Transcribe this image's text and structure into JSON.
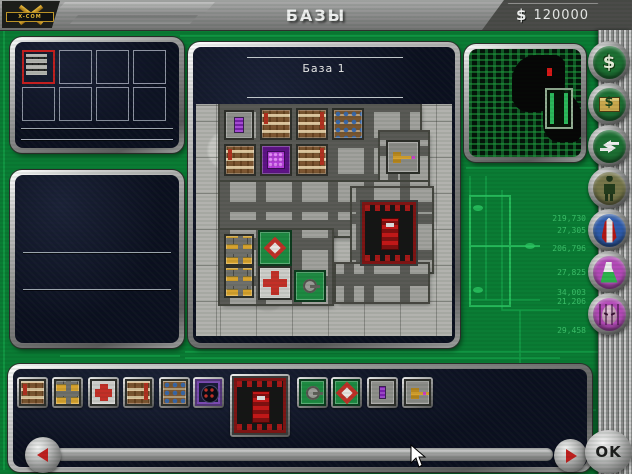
{
  "topbar": {
    "logo_text": "X-COM",
    "title": "БАЗЫ",
    "currency_glyph": "$",
    "money": "120000"
  },
  "base_list": {
    "slot_count": 8,
    "selected_index": 0
  },
  "base_view": {
    "title": "База 1",
    "facilities": [
      "access-lift",
      "living-quarters",
      "living-quarters",
      "laboratory",
      "living-quarters",
      "psi-lab",
      "living-quarters",
      "workshop",
      "general-stores",
      "missile-defense",
      "general-stores",
      "medical-bay",
      "gun-defense",
      "hangar"
    ]
  },
  "minimap": {
    "marker_color": "#d81818"
  },
  "toolbar": {
    "buttons": [
      {
        "id": "funds",
        "glyph": "$"
      },
      {
        "id": "sell",
        "glyph": "$"
      },
      {
        "id": "transfer"
      },
      {
        "id": "soldiers"
      },
      {
        "id": "craft"
      },
      {
        "id": "research"
      },
      {
        "id": "alien-containment"
      }
    ]
  },
  "facility_strip": {
    "items": [
      "living-quarters",
      "general-stores",
      "medical-bay",
      "living-quarters",
      "laboratory",
      "alien-containment",
      "hangar",
      "gun-defense",
      "missile-defense",
      "access-lift",
      "workshop"
    ]
  },
  "ok": {
    "label": "OK"
  },
  "pcb": {
    "numbers": [
      "219,730",
      "27,305",
      "206,796",
      "27,825",
      "34,003",
      "21,206",
      "29,458",
      "4,299"
    ]
  },
  "colors": {
    "background": "#0a7c34",
    "trace": "#17a94e",
    "panel": "#0b0f1f",
    "selected_slot": "#c21f1f",
    "money_text": "#e9e9e9"
  }
}
